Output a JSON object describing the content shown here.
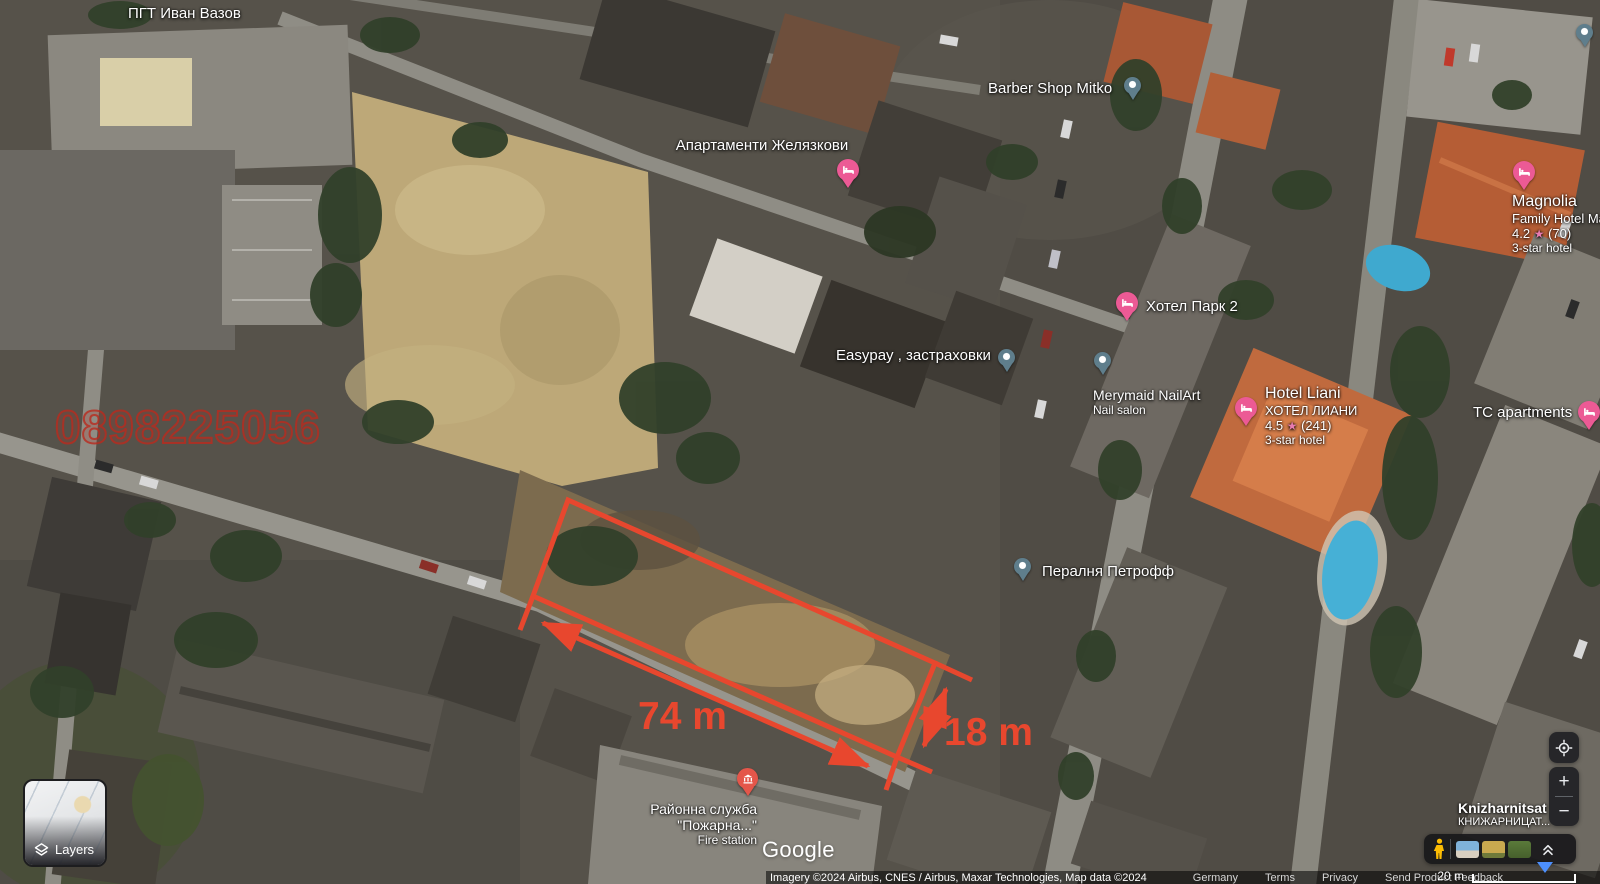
{
  "map_area_label": "ПГТ Иван Вазов",
  "watermark_phone": "0898225056",
  "measurements": {
    "length": "74 m",
    "width": "18 m"
  },
  "icons": {
    "star": "★"
  },
  "pois": [
    {
      "label": "Апартаменти Желязкови",
      "pin": "hotel"
    },
    {
      "label": "Barber Shop Mitko",
      "pin": "dot"
    },
    {
      "label": "Хотел Парк 2",
      "pin": "hotel"
    },
    {
      "label": "Easypay , застраховки",
      "pin": "dot"
    },
    {
      "label": "Merymaid NailArt",
      "sublabel": "Nail salon",
      "pin": "dot"
    },
    {
      "label": "Hotel Liani",
      "sublabel": "ХОТЕЛ ЛИАНИ",
      "rating": "4.5",
      "reviews": "(241)",
      "category": "3-star hotel",
      "pin": "hotel"
    },
    {
      "label": "Magnolia",
      "sublabel": "Family Hotel Mag",
      "rating": "4.2",
      "reviews": "(70)",
      "category": "3-star hotel",
      "pin": "hotel"
    },
    {
      "label": "TC apartments",
      "pin": "hotel"
    },
    {
      "label": "Пералня Петрофф",
      "pin": "dot"
    },
    {
      "label": "Районна служба",
      "label2": "\"Пожарна...\"",
      "sublabel": "Fire station",
      "pin": "civic"
    },
    {
      "label": "Knizharnitsat",
      "sublabel": "КНИЖАРНИЦАТ..."
    }
  ],
  "branding": {
    "logo": "Google"
  },
  "attribution": {
    "imagery": "Imagery ©2024 Airbus, CNES / Airbus, Maxar Technologies, Map data ©2024",
    "region": "Germany",
    "terms": "Terms",
    "privacy": "Privacy",
    "feedback": "Send Product Feedback",
    "scale": "20 m"
  },
  "controls": {
    "layers": "Layers",
    "zoom_in": "+",
    "zoom_out": "−"
  }
}
